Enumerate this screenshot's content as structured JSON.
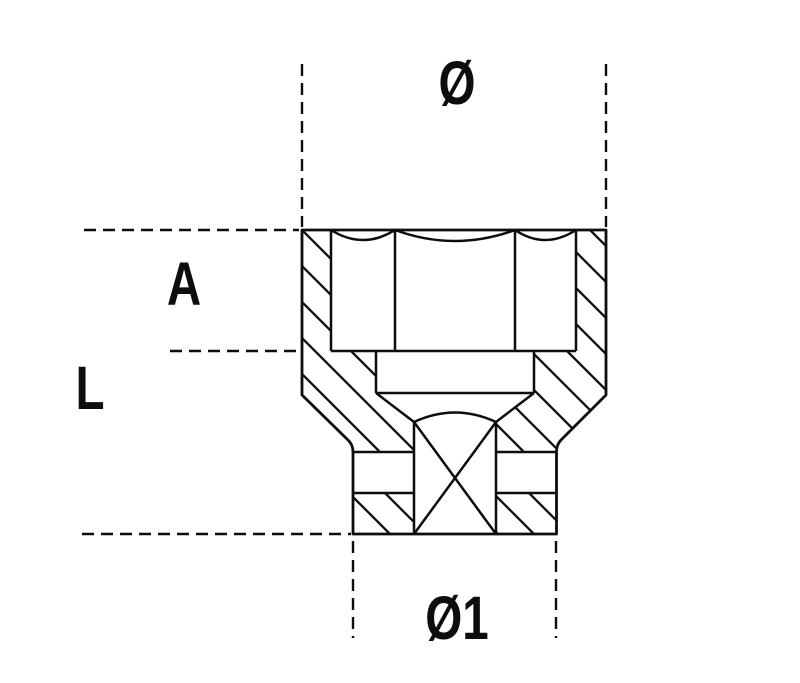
{
  "drawing": {
    "title": "socket-cross-section",
    "labels": {
      "diameter_top": "Ø",
      "depth": "A",
      "length": "L",
      "diameter_bottom": "Ø1"
    },
    "colors": {
      "line": "#0d0d0d",
      "background": "#ffffff"
    }
  }
}
